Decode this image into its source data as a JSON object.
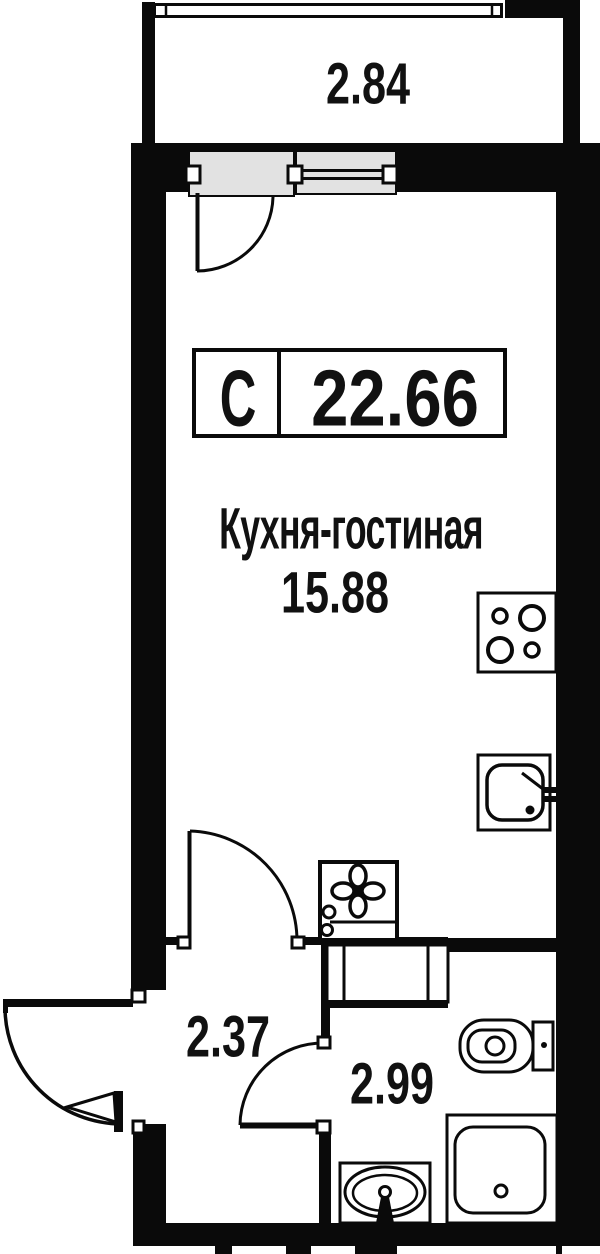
{
  "plan": {
    "title": "Studio apartment floor plan",
    "badge": {
      "type_label": "С",
      "total_area": "22.66"
    },
    "rooms": {
      "balcony": {
        "area": "2.84"
      },
      "kitchen_living": {
        "name": "Кухня-гостиная",
        "area": "15.88"
      },
      "hallway": {
        "area": "2.37"
      },
      "bathroom": {
        "area": "2.99"
      }
    },
    "fixtures": {
      "kitchen": [
        "stove-4-burners",
        "kitchen-sink"
      ],
      "bathroom": [
        "washing-machine",
        "duct-cabinet",
        "toilet",
        "shower-tray",
        "washbasin"
      ]
    },
    "colors": {
      "wall": "#0a0a0a",
      "background": "#ffffff",
      "window_panel": "#e2e2e2"
    }
  }
}
